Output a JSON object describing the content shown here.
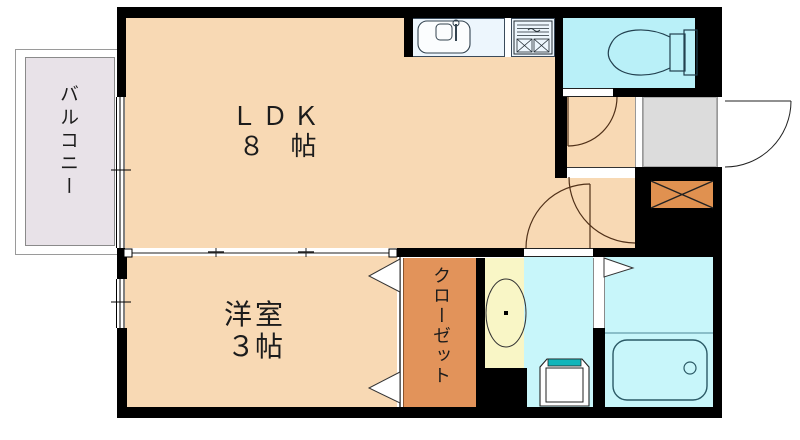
{
  "plan_title": "1K apartment floor plan",
  "rooms": {
    "balcony": {
      "label": "バルコニー"
    },
    "ldk": {
      "label": "ＬＤＫ",
      "size": "８　帖"
    },
    "western": {
      "label": "洋室",
      "size": "３帖"
    },
    "closet": {
      "label": "クローゼット"
    }
  },
  "icons": {
    "sink": "kitchen-sink-icon",
    "stove": "gas-stove-icon",
    "toilet": "toilet-icon",
    "bathtub": "bathtub-icon",
    "washer": "washing-machine-icon",
    "basin": "washbasin-oval-icon",
    "shoe_cabinet": "shoe-cabinet-x-icon",
    "entrance_door": "entrance-door-swing-icon",
    "interior_door": "door-swing-arc-icon",
    "closet_door": "folding-door-triangle-icon",
    "bath_door": "folding-door-triangle-icon",
    "window": "window-double-line-icon"
  },
  "colors": {
    "room_peach": "#f8d9b4",
    "toilet_cyan": "#b9f0f8",
    "wet_cyan": "#c8f6fa",
    "washbasin_yellow": "#f9f6c6",
    "closet_orange": "#e2935a",
    "cabinet_orange": "#e09150",
    "balcony_gray": "#e8e2e8",
    "entrance_gray": "#dcdcdc",
    "counter_blue": "#edf6fd",
    "washer_teal": "#12b5ba",
    "wall": "#000000"
  }
}
